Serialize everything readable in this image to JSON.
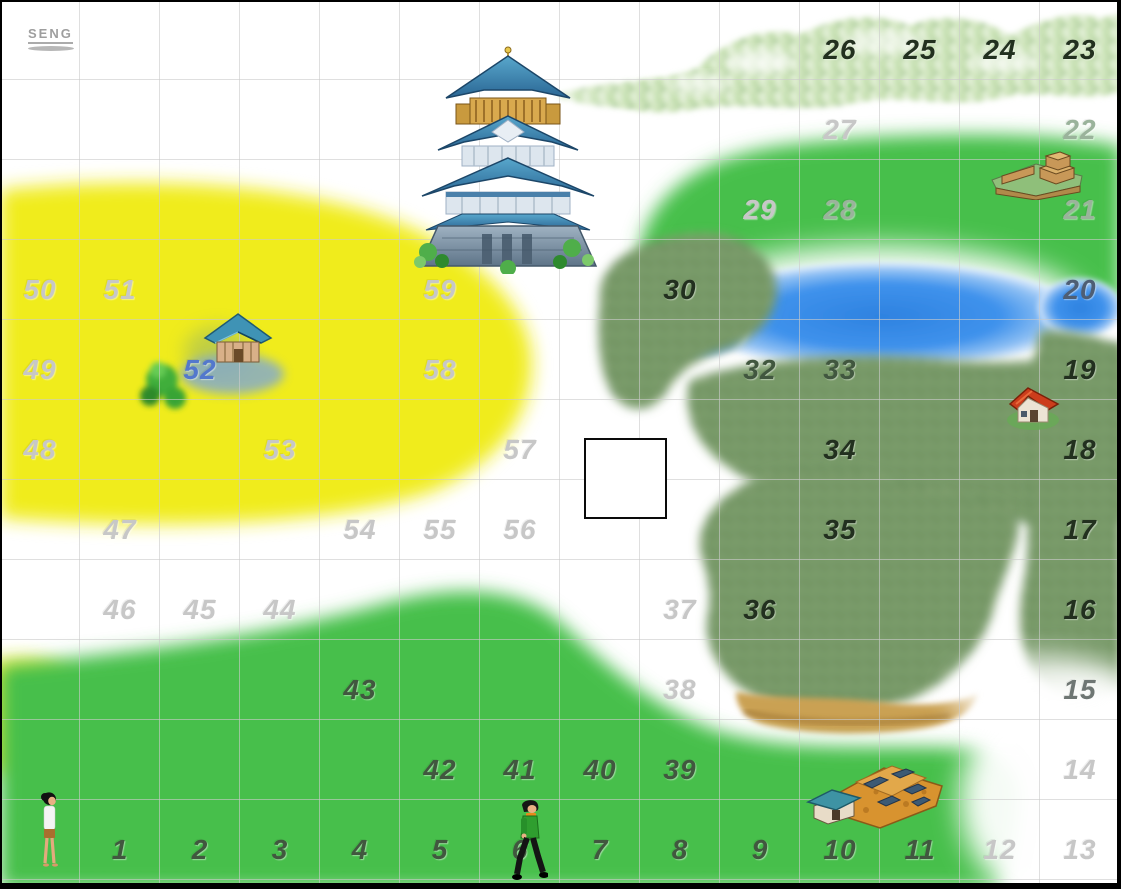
{
  "logo": {
    "text": "SENG"
  },
  "board": {
    "cols": 14,
    "rows": 11,
    "cell_px": 80
  },
  "palette": {
    "light": "#c7c7c7",
    "mid": "#9ab39b",
    "dark": "#41573f",
    "black": "#22301f",
    "gray": "#6e7673",
    "lakenum": "#4e5e74",
    "blue": "#5378cc"
  },
  "grid": {
    "cells": [
      {
        "n": "26",
        "col": 10,
        "row": 0,
        "color": "black"
      },
      {
        "n": "25",
        "col": 11,
        "row": 0,
        "color": "black"
      },
      {
        "n": "24",
        "col": 12,
        "row": 0,
        "color": "black"
      },
      {
        "n": "23",
        "col": 13,
        "row": 0,
        "color": "black"
      },
      {
        "n": "27",
        "col": 10,
        "row": 1,
        "color": "light"
      },
      {
        "n": "22",
        "col": 13,
        "row": 1,
        "color": "mid"
      },
      {
        "n": "29",
        "col": 9,
        "row": 2,
        "color": "light"
      },
      {
        "n": "28",
        "col": 10,
        "row": 2,
        "color": "mid"
      },
      {
        "n": "21",
        "col": 13,
        "row": 2,
        "color": "mid"
      },
      {
        "n": "50",
        "col": 0,
        "row": 3,
        "color": "light"
      },
      {
        "n": "51",
        "col": 1,
        "row": 3,
        "color": "light"
      },
      {
        "n": "59",
        "col": 5,
        "row": 3,
        "color": "light"
      },
      {
        "n": "30",
        "col": 8,
        "row": 3,
        "color": "black"
      },
      {
        "n": "20",
        "col": 13,
        "row": 3,
        "color": "lakenum"
      },
      {
        "n": "49",
        "col": 0,
        "row": 4,
        "color": "light"
      },
      {
        "n": "52",
        "col": 2,
        "row": 4,
        "color": "blue"
      },
      {
        "n": "58",
        "col": 5,
        "row": 4,
        "color": "light"
      },
      {
        "n": "32",
        "col": 9,
        "row": 4,
        "color": "dark"
      },
      {
        "n": "33",
        "col": 10,
        "row": 4,
        "color": "dark"
      },
      {
        "n": "19",
        "col": 13,
        "row": 4,
        "color": "black"
      },
      {
        "n": "48",
        "col": 0,
        "row": 5,
        "color": "light"
      },
      {
        "n": "53",
        "col": 3,
        "row": 5,
        "color": "light"
      },
      {
        "n": "57",
        "col": 6,
        "row": 5,
        "color": "light"
      },
      {
        "n": "34",
        "col": 10,
        "row": 5,
        "color": "black"
      },
      {
        "n": "18",
        "col": 13,
        "row": 5,
        "color": "black"
      },
      {
        "n": "47",
        "col": 1,
        "row": 6,
        "color": "light"
      },
      {
        "n": "54",
        "col": 4,
        "row": 6,
        "color": "light"
      },
      {
        "n": "55",
        "col": 5,
        "row": 6,
        "color": "light"
      },
      {
        "n": "56",
        "col": 6,
        "row": 6,
        "color": "light"
      },
      {
        "n": "35",
        "col": 10,
        "row": 6,
        "color": "black"
      },
      {
        "n": "17",
        "col": 13,
        "row": 6,
        "color": "black"
      },
      {
        "n": "46",
        "col": 1,
        "row": 7,
        "color": "light"
      },
      {
        "n": "45",
        "col": 2,
        "row": 7,
        "color": "light"
      },
      {
        "n": "44",
        "col": 3,
        "row": 7,
        "color": "light"
      },
      {
        "n": "37",
        "col": 8,
        "row": 7,
        "color": "light"
      },
      {
        "n": "36",
        "col": 9,
        "row": 7,
        "color": "black"
      },
      {
        "n": "16",
        "col": 13,
        "row": 7,
        "color": "black"
      },
      {
        "n": "43",
        "col": 4,
        "row": 8,
        "color": "dark"
      },
      {
        "n": "38",
        "col": 8,
        "row": 8,
        "color": "light"
      },
      {
        "n": "15",
        "col": 13,
        "row": 8,
        "color": "gray"
      },
      {
        "n": "42",
        "col": 5,
        "row": 9,
        "color": "dark"
      },
      {
        "n": "41",
        "col": 6,
        "row": 9,
        "color": "dark"
      },
      {
        "n": "40",
        "col": 7,
        "row": 9,
        "color": "dark"
      },
      {
        "n": "39",
        "col": 8,
        "row": 9,
        "color": "dark"
      },
      {
        "n": "14",
        "col": 13,
        "row": 9,
        "color": "light"
      },
      {
        "n": "1",
        "col": 1,
        "row": 10,
        "color": "dark"
      },
      {
        "n": "2",
        "col": 2,
        "row": 10,
        "color": "dark"
      },
      {
        "n": "3",
        "col": 3,
        "row": 10,
        "color": "dark"
      },
      {
        "n": "4",
        "col": 4,
        "row": 10,
        "color": "dark"
      },
      {
        "n": "5",
        "col": 5,
        "row": 10,
        "color": "dark"
      },
      {
        "n": "6",
        "col": 6,
        "row": 10,
        "color": "dark"
      },
      {
        "n": "7",
        "col": 7,
        "row": 10,
        "color": "dark"
      },
      {
        "n": "8",
        "col": 8,
        "row": 10,
        "color": "dark"
      },
      {
        "n": "9",
        "col": 9,
        "row": 10,
        "color": "dark"
      },
      {
        "n": "10",
        "col": 10,
        "row": 10,
        "color": "dark"
      },
      {
        "n": "11",
        "col": 11,
        "row": 10,
        "color": "dark"
      },
      {
        "n": "12",
        "col": 12,
        "row": 10,
        "color": "light"
      },
      {
        "n": "13",
        "col": 13,
        "row": 10,
        "color": "light"
      }
    ]
  },
  "objects": [
    {
      "id": "main-castle",
      "label": "large blue castle"
    },
    {
      "id": "estate-house",
      "label": "small blue-roof house at cell 52"
    },
    {
      "id": "hill-fort",
      "label": "fort on grass near cells 21-22"
    },
    {
      "id": "red-house",
      "label": "red-roof house near cell 19"
    },
    {
      "id": "construction-site",
      "label": "orange building site near cells 10-11"
    },
    {
      "id": "female-character",
      "label": "woman figure, bottom left"
    },
    {
      "id": "male-character",
      "label": "man figure at cell 6"
    },
    {
      "id": "selection-box",
      "label": "empty white marker square near cell 57"
    }
  ],
  "terrain_colors": {
    "grass": "#46c24b",
    "field_yellow": "#f2ee16",
    "forest": "#7a9e6b",
    "mountain": "#cfe5bb",
    "lake": "#2e82e0",
    "cliff": "#caa152"
  }
}
